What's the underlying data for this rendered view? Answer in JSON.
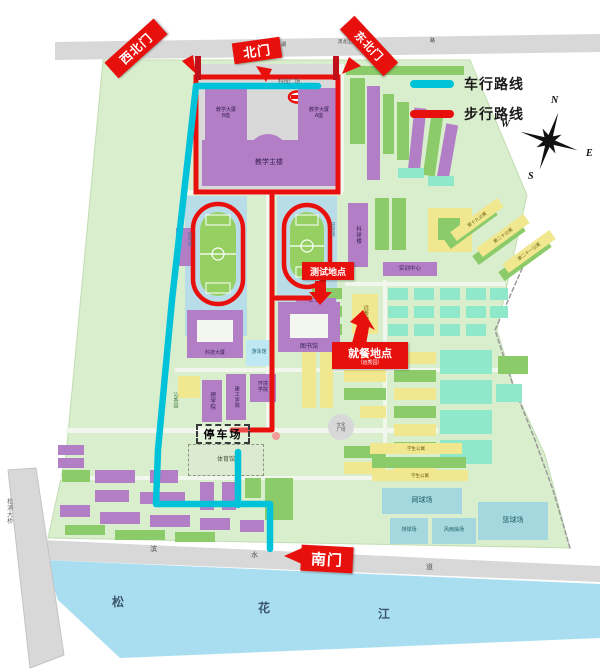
{
  "gates": {
    "nw": {
      "label": "西北门"
    },
    "n": {
      "label": "北门"
    },
    "ne": {
      "label": "东北门"
    },
    "s": {
      "label": "南门"
    }
  },
  "legend": {
    "vehicle": "车行路线",
    "walking": "步行路线"
  },
  "compass": {
    "n": "N",
    "w": "W",
    "e": "E",
    "s": "S"
  },
  "annotations": {
    "test": {
      "label": "测试地点"
    },
    "dine": {
      "label": "就餐地点",
      "sub": "（远秀园）"
    },
    "parking": {
      "label": "停车场"
    }
  },
  "colors": {
    "P": "#b27fc7",
    "G": "#8ccb69",
    "Y": "#f1e78f",
    "T": "#8fe8ca",
    "C": "#bfe9f2",
    "B": "#a5d8de",
    "GY": "#dcead2",
    "GR": "#d8d8d8",
    "campus": "#d9eecd",
    "road": "#f2f7ee",
    "gray": "#d9d9d9",
    "river": "#a9def1",
    "band": "#d8d8d8",
    "red": "#e8100c",
    "cyan": "#00c3da",
    "darkred": "#c0111a",
    "trackbg": "#b9dce9",
    "field": "#96d063"
  },
  "geometry": {
    "campus": [
      [
        103,
        60
      ],
      [
        470,
        60
      ],
      [
        527,
        195
      ],
      [
        497,
        330
      ],
      [
        515,
        390
      ],
      [
        545,
        455
      ],
      [
        570,
        548
      ],
      [
        48,
        538
      ],
      [
        66,
        455
      ]
    ],
    "roads": [
      [
        183,
        190,
        160,
        5
      ],
      [
        66,
        428,
        372,
        5
      ],
      [
        60,
        476,
        374,
        4
      ],
      [
        175,
        368,
        330,
        4
      ],
      [
        266,
        192,
        5,
        240
      ],
      [
        338,
        64,
        6,
        128
      ],
      [
        345,
        282,
        160,
        4
      ],
      [
        383,
        280,
        4,
        196
      ]
    ],
    "top_road": [
      [
        55,
        42
      ],
      [
        600,
        34
      ],
      [
        600,
        52
      ],
      [
        55,
        60
      ]
    ],
    "plaza": [
      199,
      64,
      137,
      127
    ],
    "bottom_road": [
      [
        42,
        540
      ],
      [
        600,
        566
      ],
      [
        600,
        582
      ],
      [
        46,
        560
      ]
    ],
    "river": [
      [
        44,
        560
      ],
      [
        600,
        584
      ],
      [
        600,
        638
      ],
      [
        120,
        658
      ],
      [
        58,
        600
      ]
    ],
    "bridge": [
      [
        8,
        470
      ],
      [
        36,
        468
      ],
      [
        64,
        655
      ],
      [
        30,
        668
      ]
    ],
    "boundary": [
      [
        525,
        262
      ],
      [
        495,
        330
      ],
      [
        512,
        382
      ],
      [
        535,
        440
      ],
      [
        553,
        490
      ],
      [
        570,
        548
      ]
    ],
    "fountain": [
      297,
      97
    ],
    "compass_center": [
      549,
      141
    ]
  },
  "tracks": {
    "west": {
      "bg": [
        185,
        196,
        62,
        140
      ],
      "ring": [
        193,
        204,
        50,
        100
      ],
      "field": [
        200,
        212,
        36,
        84
      ]
    },
    "east": {
      "bg": [
        277,
        196,
        60,
        106
      ],
      "ring": [
        284,
        205,
        46,
        82
      ],
      "field": [
        290,
        212,
        34,
        68
      ]
    }
  },
  "routes": {
    "vehicle": [
      [
        [
          318,
          86
        ],
        [
          196,
          86
        ],
        [
          172,
          300
        ],
        [
          158,
          450
        ],
        [
          156,
          504
        ],
        [
          270,
          504
        ],
        [
          270,
          549
        ]
      ],
      [
        [
          238,
          452
        ],
        [
          238,
          505
        ]
      ]
    ],
    "walking_rect": [
      196,
      77,
      142,
      115
    ],
    "walking": [
      [
        [
          272,
          192
        ],
        [
          272,
          430
        ],
        [
          232,
          430
        ]
      ],
      [
        [
          272,
          298
        ],
        [
          310,
          298
        ]
      ]
    ],
    "end_dot": [
      276,
      436
    ],
    "gate_stubs": [
      [
        195,
        56,
        6,
        24
      ],
      [
        333,
        56,
        6,
        24
      ]
    ]
  },
  "arrows": [
    {
      "name": "northwest-gate-arrow",
      "pts": [
        [
          196,
          74
        ],
        [
          182,
          61
        ],
        [
          193,
          55
        ]
      ]
    },
    {
      "name": "north-gate-arrow",
      "pts": [
        [
          266,
          82
        ],
        [
          256,
          66
        ],
        [
          272,
          69
        ]
      ]
    },
    {
      "name": "northeast-gate-arrow",
      "pts": [
        [
          342,
          74
        ],
        [
          349,
          57
        ],
        [
          361,
          66
        ]
      ]
    },
    {
      "name": "south-gate-arrow",
      "pts": [
        [
          284,
          556
        ],
        [
          302,
          548
        ],
        [
          302,
          564
        ]
      ]
    },
    {
      "name": "test-location-arrow",
      "pts": [
        [
          315,
          281
        ],
        [
          326,
          281
        ],
        [
          326,
          292
        ],
        [
          332,
          292
        ],
        [
          320,
          305
        ],
        [
          309,
          292
        ],
        [
          315,
          292
        ]
      ]
    },
    {
      "name": "dining-location-arrow",
      "pts": [
        [
          352,
          343
        ],
        [
          366,
          345
        ],
        [
          369,
          327
        ],
        [
          375,
          330
        ],
        [
          363,
          310
        ],
        [
          350,
          322
        ],
        [
          357,
          325
        ]
      ]
    }
  ],
  "buildings": [
    {
      "x": 205,
      "y": 88,
      "w": 42,
      "h": 52,
      "c": "P",
      "label": "教学大厦\nB座",
      "fz": 5
    },
    {
      "x": 298,
      "y": 88,
      "w": 42,
      "h": 52,
      "c": "P",
      "label": "教学大厦\nA座",
      "fz": 5
    },
    {
      "x": 248,
      "y": 134,
      "w": 40,
      "h": 40,
      "c": "P",
      "r": 20
    },
    {
      "x": 202,
      "y": 140,
      "w": 134,
      "h": 46,
      "c": "P",
      "label": "教学主楼",
      "fz": 7
    },
    {
      "x": 296,
      "y": 298,
      "w": 40,
      "h": 13,
      "c": "P",
      "label": "综合楼",
      "fz": 5
    },
    {
      "x": 278,
      "y": 302,
      "w": 62,
      "h": 50,
      "c": "P",
      "hole": [
        290,
        314,
        38,
        24
      ],
      "label": "图书馆",
      "fz": 6,
      "labelAt": "bottom"
    },
    {
      "x": 187,
      "y": 310,
      "w": 56,
      "h": 48,
      "c": "P",
      "hole": [
        197,
        320,
        36,
        22
      ],
      "label": "科技大厦",
      "fz": 5,
      "labelAt": "bottom"
    },
    {
      "x": 246,
      "y": 340,
      "w": 26,
      "h": 26,
      "c": "C",
      "label": "游泳馆",
      "fz": 5
    },
    {
      "x": 202,
      "y": 380,
      "w": 20,
      "h": 42,
      "c": "P",
      "label": "理学院",
      "fz": 5.5,
      "vert": 1
    },
    {
      "x": 226,
      "y": 374,
      "w": 20,
      "h": 46,
      "c": "P",
      "label": "建工学院",
      "fz": 5,
      "vert": 1
    },
    {
      "x": 250,
      "y": 374,
      "w": 26,
      "h": 28,
      "c": "P",
      "label": "环境\n学院",
      "fz": 5
    },
    {
      "x": 188,
      "y": 444,
      "w": 76,
      "h": 32,
      "c": "GY",
      "label": "体育馆",
      "fz": 6,
      "dashed": 1
    },
    {
      "x": 348,
      "y": 203,
      "w": 20,
      "h": 64,
      "c": "P",
      "label": "科研楼",
      "fz": 5.5,
      "vert": 1
    },
    {
      "x": 383,
      "y": 262,
      "w": 54,
      "h": 14,
      "c": "P",
      "label": "实训中心",
      "fz": 5.5
    },
    {
      "x": 352,
      "y": 294,
      "w": 26,
      "h": 40,
      "c": "Y",
      "label": "远秀园",
      "fz": 5.5,
      "vert": 1
    },
    {
      "x": 382,
      "y": 488,
      "w": 80,
      "h": 26,
      "c": "B",
      "label": "网球场",
      "fz": 7
    },
    {
      "x": 478,
      "y": 502,
      "w": 70,
      "h": 38,
      "c": "B",
      "label": "篮球场",
      "fz": 7
    },
    {
      "x": 390,
      "y": 518,
      "w": 38,
      "h": 26,
      "c": "B",
      "label": "排球场",
      "fz": 5
    },
    {
      "x": 432,
      "y": 518,
      "w": 44,
      "h": 26,
      "c": "B",
      "label": "风雨操场",
      "fz": 5
    },
    {
      "x": 328,
      "y": 414,
      "w": 26,
      "h": 26,
      "c": "GR",
      "r": 13,
      "label": "文化\n广场",
      "fz": 4.5
    },
    {
      "x": 370,
      "y": 443,
      "w": 92,
      "h": 11,
      "c": "Y",
      "label": "学生公寓",
      "fz": 4.5
    },
    {
      "x": 372,
      "y": 470,
      "w": 96,
      "h": 11,
      "c": "Y",
      "label": "学生公寓",
      "fz": 4.5
    },
    {
      "x": 448,
      "y": 214,
      "w": 58,
      "h": 11,
      "c": "Y",
      "rot": -36,
      "label": "第十九公寓",
      "fz": 4.5
    },
    {
      "x": 474,
      "y": 230,
      "w": 58,
      "h": 11,
      "c": "Y",
      "rot": -36,
      "label": "第二十公寓",
      "fz": 4.5
    },
    {
      "x": 500,
      "y": 246,
      "w": 58,
      "h": 11,
      "c": "Y",
      "rot": -36,
      "label": "第二十一公寓",
      "fz": 4.5
    }
  ],
  "filler": [
    [
      176,
      228,
      15,
      38,
      "P"
    ],
    [
      346,
      66,
      118,
      9,
      "G"
    ],
    [
      350,
      78,
      15,
      66,
      "G"
    ],
    [
      367,
      86,
      13,
      94,
      "P"
    ],
    [
      383,
      94,
      11,
      60,
      "G"
    ],
    [
      397,
      102,
      12,
      58,
      "G"
    ],
    [
      411,
      108,
      12,
      66,
      "P",
      6
    ],
    [
      427,
      116,
      12,
      60,
      "G",
      8
    ],
    [
      441,
      124,
      12,
      60,
      "P",
      10
    ],
    [
      398,
      168,
      26,
      10,
      "T"
    ],
    [
      428,
      176,
      26,
      10,
      "T"
    ],
    [
      375,
      198,
      14,
      52,
      "G"
    ],
    [
      392,
      198,
      14,
      52,
      "G"
    ],
    [
      428,
      208,
      44,
      44,
      "Y"
    ],
    [
      438,
      218,
      22,
      22,
      "G"
    ],
    [
      442,
      222,
      58,
      11,
      "G",
      -36
    ],
    [
      470,
      238,
      58,
      11,
      "G",
      -36
    ],
    [
      496,
      254,
      58,
      11,
      "G",
      -36
    ],
    [
      312,
      288,
      30,
      11,
      "G"
    ],
    [
      312,
      306,
      30,
      11,
      "G"
    ],
    [
      312,
      324,
      30,
      11,
      "G"
    ],
    [
      388,
      288,
      20,
      12,
      "T"
    ],
    [
      414,
      288,
      20,
      12,
      "T"
    ],
    [
      440,
      288,
      20,
      12,
      "T"
    ],
    [
      466,
      288,
      20,
      12,
      "T"
    ],
    [
      490,
      288,
      18,
      12,
      "T"
    ],
    [
      388,
      306,
      20,
      12,
      "T"
    ],
    [
      414,
      306,
      20,
      12,
      "T"
    ],
    [
      440,
      306,
      20,
      12,
      "T"
    ],
    [
      466,
      306,
      20,
      12,
      "T"
    ],
    [
      490,
      306,
      18,
      12,
      "T"
    ],
    [
      388,
      324,
      20,
      12,
      "T"
    ],
    [
      414,
      324,
      20,
      12,
      "T"
    ],
    [
      440,
      324,
      20,
      12,
      "T"
    ],
    [
      466,
      324,
      20,
      12,
      "T"
    ],
    [
      302,
      352,
      14,
      56,
      "Y"
    ],
    [
      320,
      352,
      13,
      56,
      "Y"
    ],
    [
      344,
      352,
      42,
      12,
      "G"
    ],
    [
      344,
      370,
      42,
      12,
      "Y"
    ],
    [
      344,
      388,
      42,
      12,
      "G"
    ],
    [
      360,
      406,
      26,
      12,
      "Y"
    ],
    [
      344,
      446,
      42,
      12,
      "G"
    ],
    [
      344,
      462,
      42,
      12,
      "Y"
    ],
    [
      394,
      352,
      42,
      12,
      "Y"
    ],
    [
      394,
      370,
      42,
      12,
      "G"
    ],
    [
      394,
      388,
      42,
      12,
      "Y"
    ],
    [
      394,
      406,
      42,
      12,
      "G"
    ],
    [
      394,
      424,
      42,
      12,
      "Y"
    ],
    [
      394,
      442,
      42,
      12,
      "G"
    ],
    [
      394,
      460,
      42,
      12,
      "Y"
    ],
    [
      440,
      350,
      52,
      24,
      "T"
    ],
    [
      440,
      380,
      52,
      24,
      "T"
    ],
    [
      440,
      410,
      52,
      24,
      "T"
    ],
    [
      440,
      440,
      52,
      24,
      "T"
    ],
    [
      498,
      356,
      30,
      18,
      "G"
    ],
    [
      496,
      384,
      26,
      18,
      "T"
    ],
    [
      372,
      457,
      94,
      11,
      "G"
    ],
    [
      58,
      445,
      26,
      10,
      "P"
    ],
    [
      58,
      458,
      26,
      10,
      "P"
    ],
    [
      62,
      470,
      28,
      12,
      "G"
    ],
    [
      95,
      470,
      40,
      13,
      "P"
    ],
    [
      150,
      470,
      28,
      13,
      "P"
    ],
    [
      95,
      490,
      34,
      12,
      "P"
    ],
    [
      140,
      492,
      45,
      12,
      "P"
    ],
    [
      200,
      482,
      14,
      28,
      "P"
    ],
    [
      222,
      482,
      14,
      28,
      "P"
    ],
    [
      245,
      478,
      16,
      20,
      "G"
    ],
    [
      265,
      478,
      28,
      42,
      "G"
    ],
    [
      60,
      505,
      30,
      12,
      "P"
    ],
    [
      100,
      512,
      40,
      12,
      "P"
    ],
    [
      150,
      515,
      40,
      12,
      "P"
    ],
    [
      200,
      518,
      30,
      12,
      "P"
    ],
    [
      240,
      520,
      24,
      12,
      "P"
    ],
    [
      65,
      525,
      40,
      10,
      "G"
    ],
    [
      115,
      530,
      50,
      10,
      "G"
    ],
    [
      175,
      532,
      40,
      10,
      "G"
    ],
    [
      178,
      376,
      22,
      22,
      "Y"
    ]
  ],
  "floating_labels": [
    {
      "t": "科技广场",
      "x": 278,
      "y": 79,
      "fz": 5.5,
      "c": "#555"
    },
    {
      "t": "湖",
      "x": 281,
      "y": 43,
      "fz": 5,
      "c": "#444"
    },
    {
      "t": "黑龙江科技大学站",
      "x": 338,
      "y": 40,
      "fz": 4.5,
      "c": "#444"
    },
    {
      "t": "路",
      "x": 430,
      "y": 39,
      "fz": 5,
      "c": "#444"
    },
    {
      "t": "田径场",
      "x": 187,
      "y": 232,
      "fz": 4.5,
      "c": "#49708e",
      "v": 1
    },
    {
      "t": "田径场",
      "x": 330,
      "y": 222,
      "fz": 4.5,
      "c": "#49708e",
      "v": 1
    },
    {
      "t": "沁香园",
      "x": 172,
      "y": 392,
      "fz": 5,
      "c": "#3f7a3f",
      "v": 1
    },
    {
      "t": "松浦大桥",
      "x": 5,
      "y": 498,
      "fz": 6,
      "c": "#666",
      "v": 1
    },
    {
      "t": "滨",
      "x": 150,
      "y": 546,
      "fz": 7,
      "c": "#555"
    },
    {
      "t": "水",
      "x": 251,
      "y": 552,
      "fz": 7,
      "c": "#555"
    },
    {
      "t": "大",
      "x": 325,
      "y": 558,
      "fz": 7,
      "c": "#555"
    },
    {
      "t": "道",
      "x": 426,
      "y": 564,
      "fz": 7,
      "c": "#555"
    },
    {
      "t": "松",
      "x": 112,
      "y": 596,
      "fz": 12,
      "c": "#3d566b",
      "b": 1
    },
    {
      "t": "花",
      "x": 258,
      "y": 602,
      "fz": 12,
      "c": "#3d566b",
      "b": 1
    },
    {
      "t": "江",
      "x": 378,
      "y": 608,
      "fz": 12,
      "c": "#3d566b",
      "b": 1
    }
  ]
}
